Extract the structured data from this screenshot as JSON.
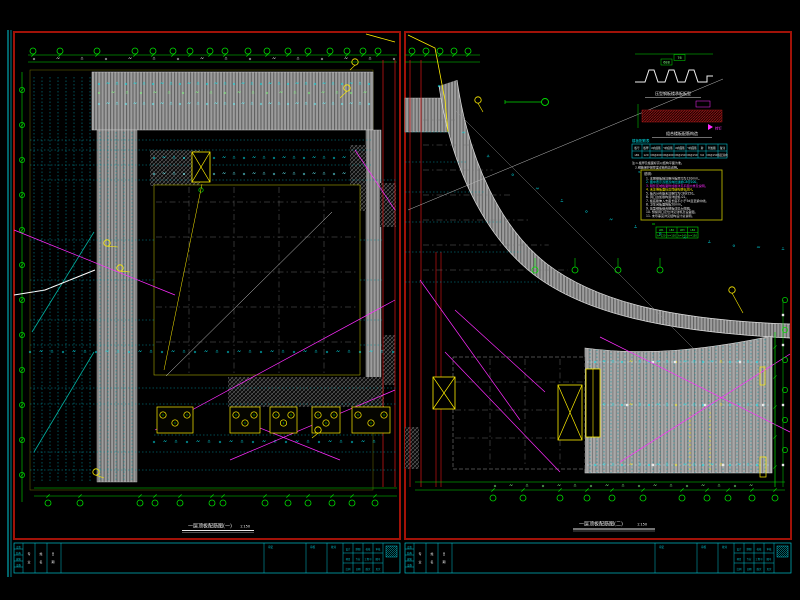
{
  "colors": {
    "bg": "#000000",
    "frame": "#a11208",
    "cyan": "#00e5ee",
    "cyan_dim": "#00939e",
    "tb_cyan": "#00c2cf",
    "green": "#00dd00",
    "green_dark": "#00a000",
    "yellow": "#ffee00",
    "magenta": "#ff2bff",
    "white": "#f0f0f0",
    "gray_line": "#6f6f6f",
    "teal": "#00b2a2",
    "red_line": "#c41414",
    "olive": "#b5b300",
    "slab": "#9c9c9c"
  },
  "sheet_a": {
    "title": "一层顶板配筋图(一)",
    "scale": "1:150"
  },
  "sheet_b": {
    "title": "一层顶板配筋图(二)",
    "scale": "1:150"
  },
  "details": {
    "deck": {
      "title": "压型钢板楼承板板型",
      "label_a": "688",
      "label_b": "76"
    },
    "section": {
      "title": "组合楼板配筋构造",
      "tag": "栓钉"
    },
    "table": {
      "caption": "楼板配筋表",
      "headers": [
        "板号",
        "板厚",
        "X向底筋",
        "Y向底筋",
        "X向面筋",
        "Y向面筋",
        "跨",
        "附加筋",
        "备注"
      ],
      "row": [
        "LB1",
        "120",
        "C8@200",
        "C8@200",
        "C8@150",
        "C8@150",
        "3.6",
        "C8@150",
        "双层双向"
      ]
    },
    "table_notes": [
      "注:1.板厚及板面标高以结构平面为准。",
      "2.钢筋保护层厚度详结构总说明。",
      "3.图中未注明板底筋均为C8@200双向拉通。"
    ],
    "notes": {
      "title": "说明:",
      "lines": [
        "1. 本层楼板除注明外板厚均为120mm。",
        "2. 图中表示双层双向拉通筋C8@200。",
        "3. 阴影区域板面附加筋详见平面大样及说明。",
        "4. 未注明板面标高同结构层标高H。",
        "5. 板内分布筋未注明均为C8@250。",
        "6. 洞口边加筋构造详结施-01。",
        "7. 板底筋伸入支座长度不小于5d且至梁中线。",
        "8. 卫生间板面降板50mm。",
        "9. 压型钢板组合楼板详见大样图。",
        "10. 预留洞口定位详见建筑及设备图。",
        "11. 未尽事宜详见结构设计总说明。"
      ],
      "line_colors": [
        "#e8e8e8",
        "#00e5ee",
        "#ff2bff",
        "#ffee00",
        "#e8e8e8",
        "#e8e8e8",
        "#e8e8e8",
        "#e8e8e8",
        "#e8e8e8",
        "#e8e8e8",
        "#e8e8e8"
      ]
    },
    "legend": {
      "rows": [
        [
          "LB1",
          "LB2",
          "LB3",
          "LB4"
        ],
        [
          "h=120",
          "h=130",
          "h=140",
          "h=150"
        ]
      ]
    }
  },
  "titleblock": {
    "col1": [
      "会签",
      "结构",
      "建筑",
      "设备"
    ],
    "cols": [
      "专业",
      "姓名",
      "日期"
    ],
    "mid": [
      "审定",
      "审核",
      "校对"
    ],
    "cells": [
      "设计",
      "制图",
      "校核",
      "审核",
      "项目",
      "专业",
      "工程号",
      "图号",
      "比例",
      "日期",
      "版次",
      "页次"
    ]
  }
}
